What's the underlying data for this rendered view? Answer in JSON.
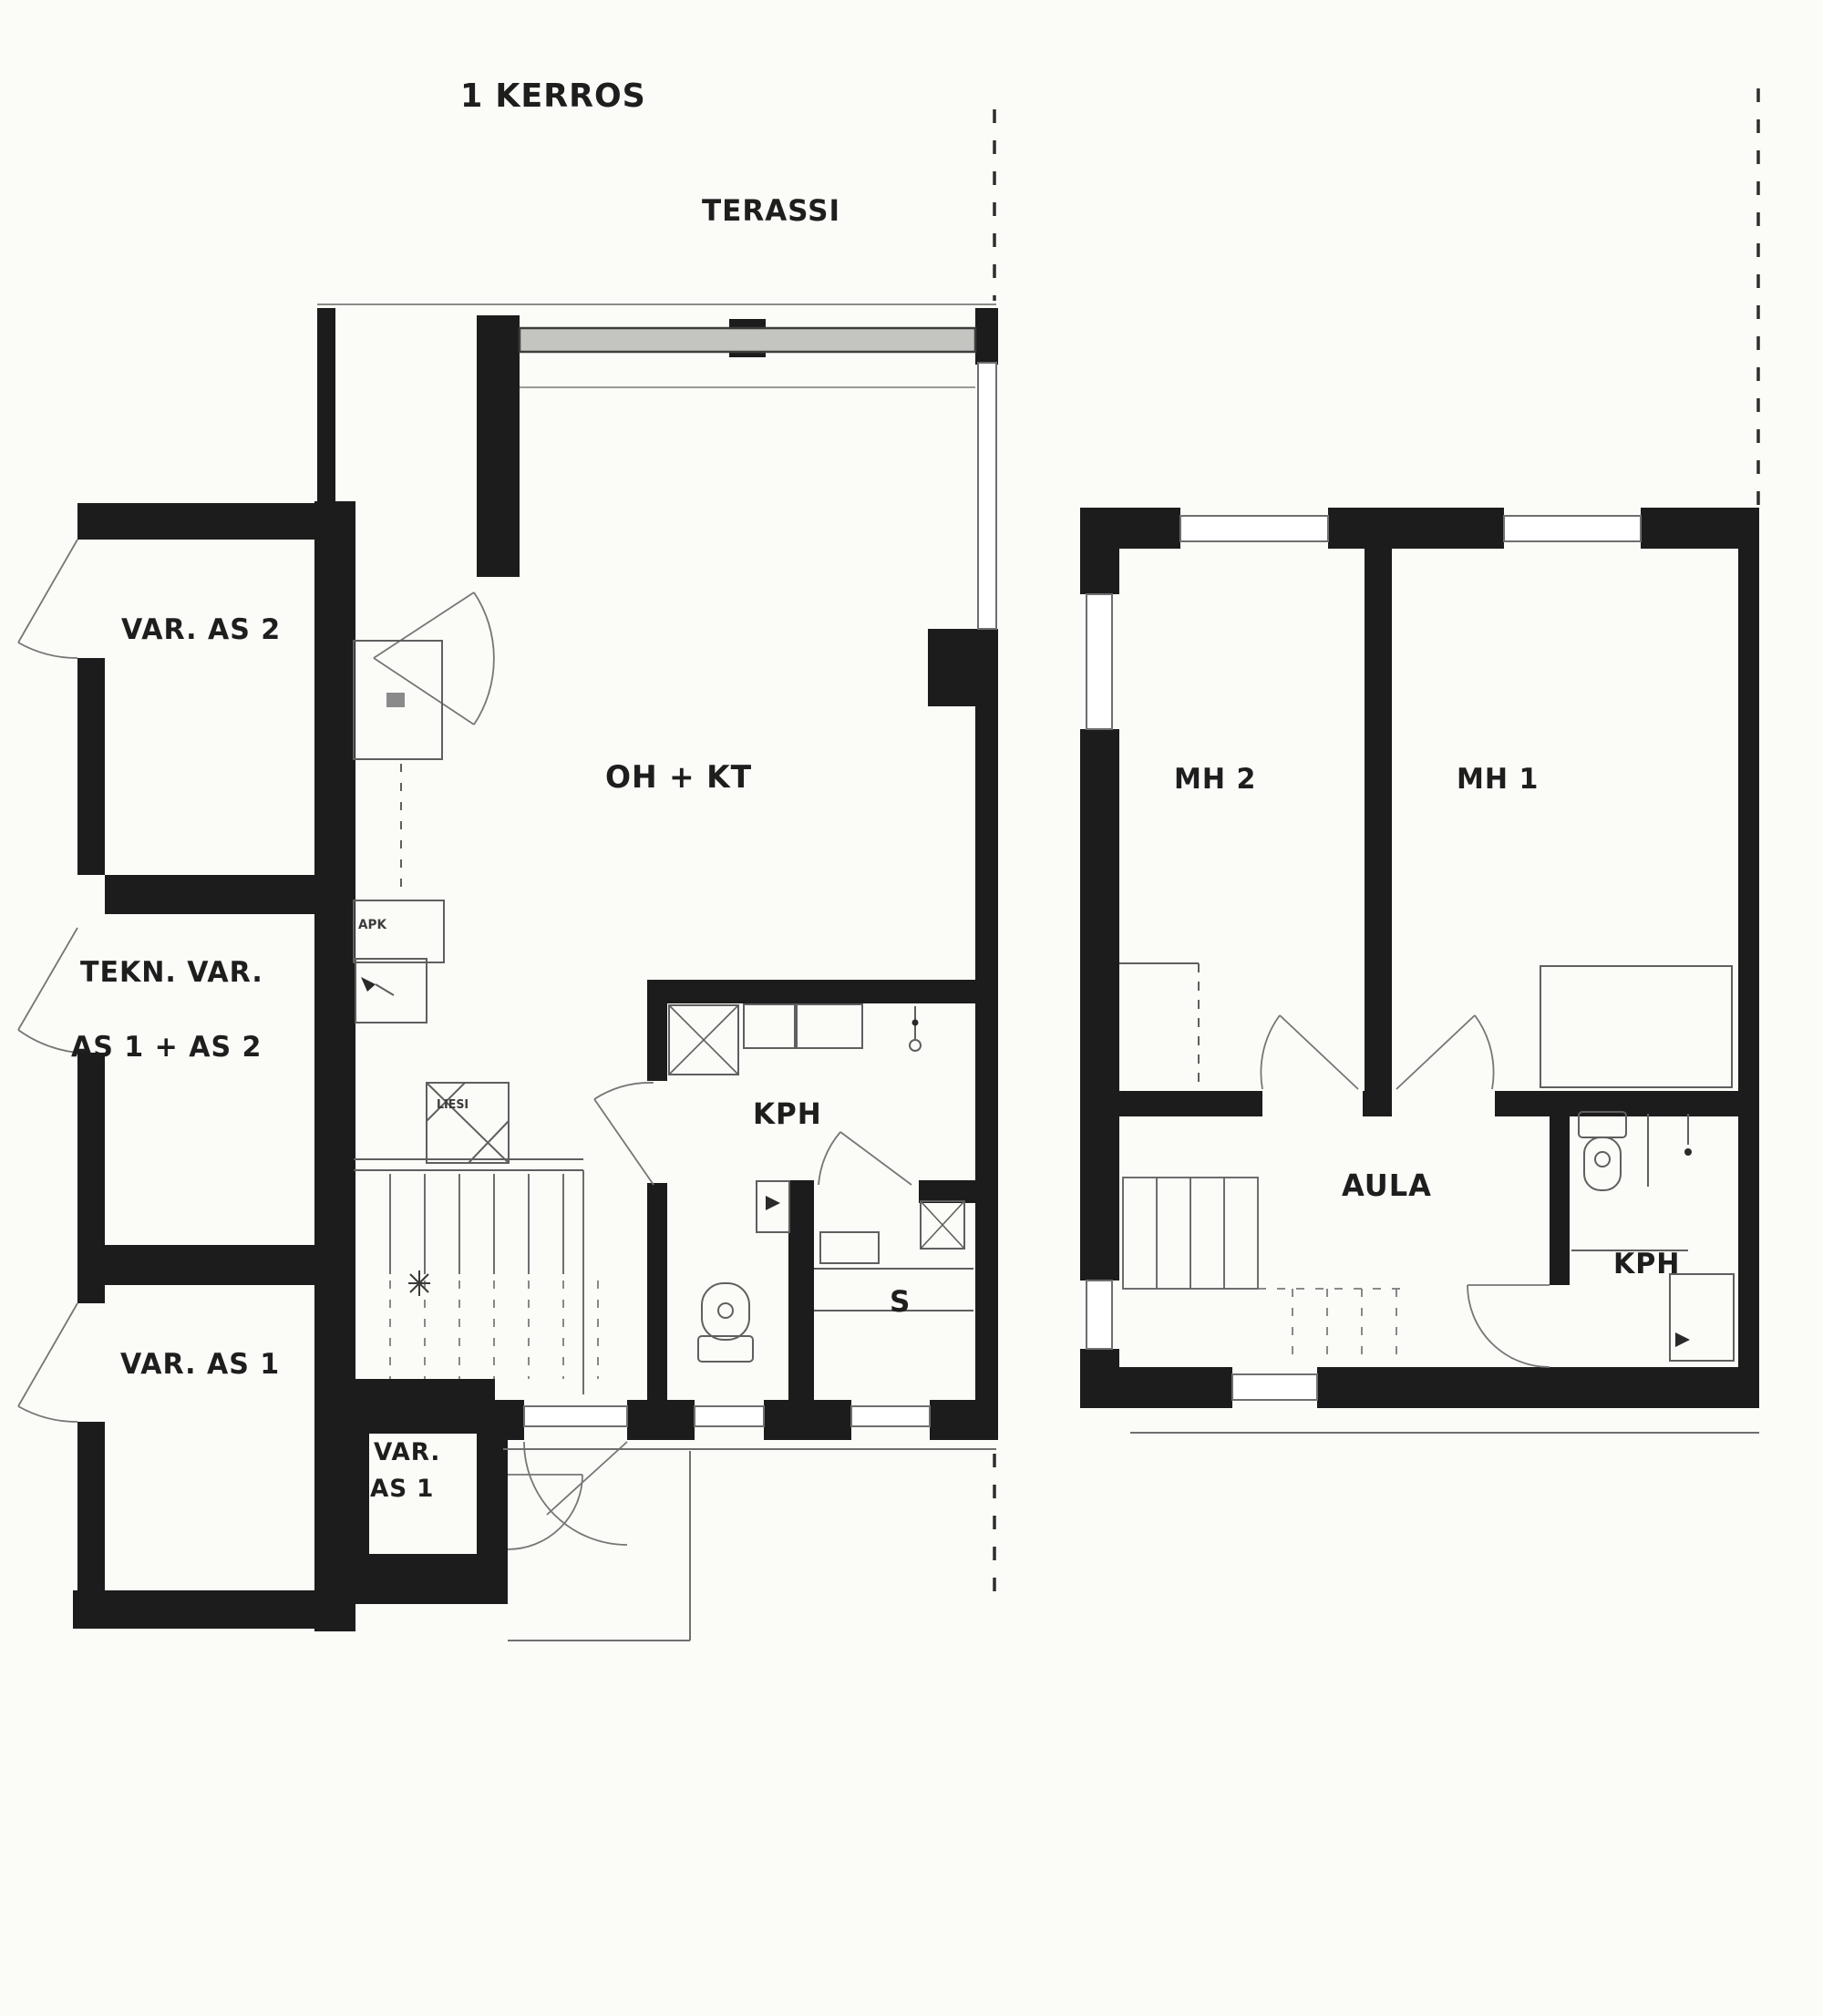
{
  "page": {
    "background": "#fbfbf8",
    "type": "scanned architectural floor plan"
  },
  "colors": {
    "wall": "#1c1c1c",
    "thin_line": "#5f5f5f",
    "light_line": "#8a8a8a",
    "glass_fill": "#c4c4c0",
    "text": "#1e1e1e"
  },
  "title": "1 KERROS",
  "floor1": {
    "terrace_label": "TERASSI",
    "rooms": {
      "storage_apt2": "VAR. AS 2",
      "technical_storage_line1": "TEKN. VAR.",
      "technical_storage_line2": "AS 1 + AS 2",
      "storage_apt1": "VAR. AS 1",
      "storage_apt1_small_line1": "VAR.",
      "storage_apt1_small_line2": "AS 1",
      "living_kitchen": "OH + KT",
      "bathroom": "KPH",
      "sauna": "S"
    },
    "appliances": {
      "dishwasher": "APK",
      "stove": "LIESI"
    }
  },
  "floor2": {
    "rooms": {
      "bedroom2": "MH 2",
      "bedroom1": "MH 1",
      "hall": "AULA",
      "bathroom": "KPH"
    }
  }
}
